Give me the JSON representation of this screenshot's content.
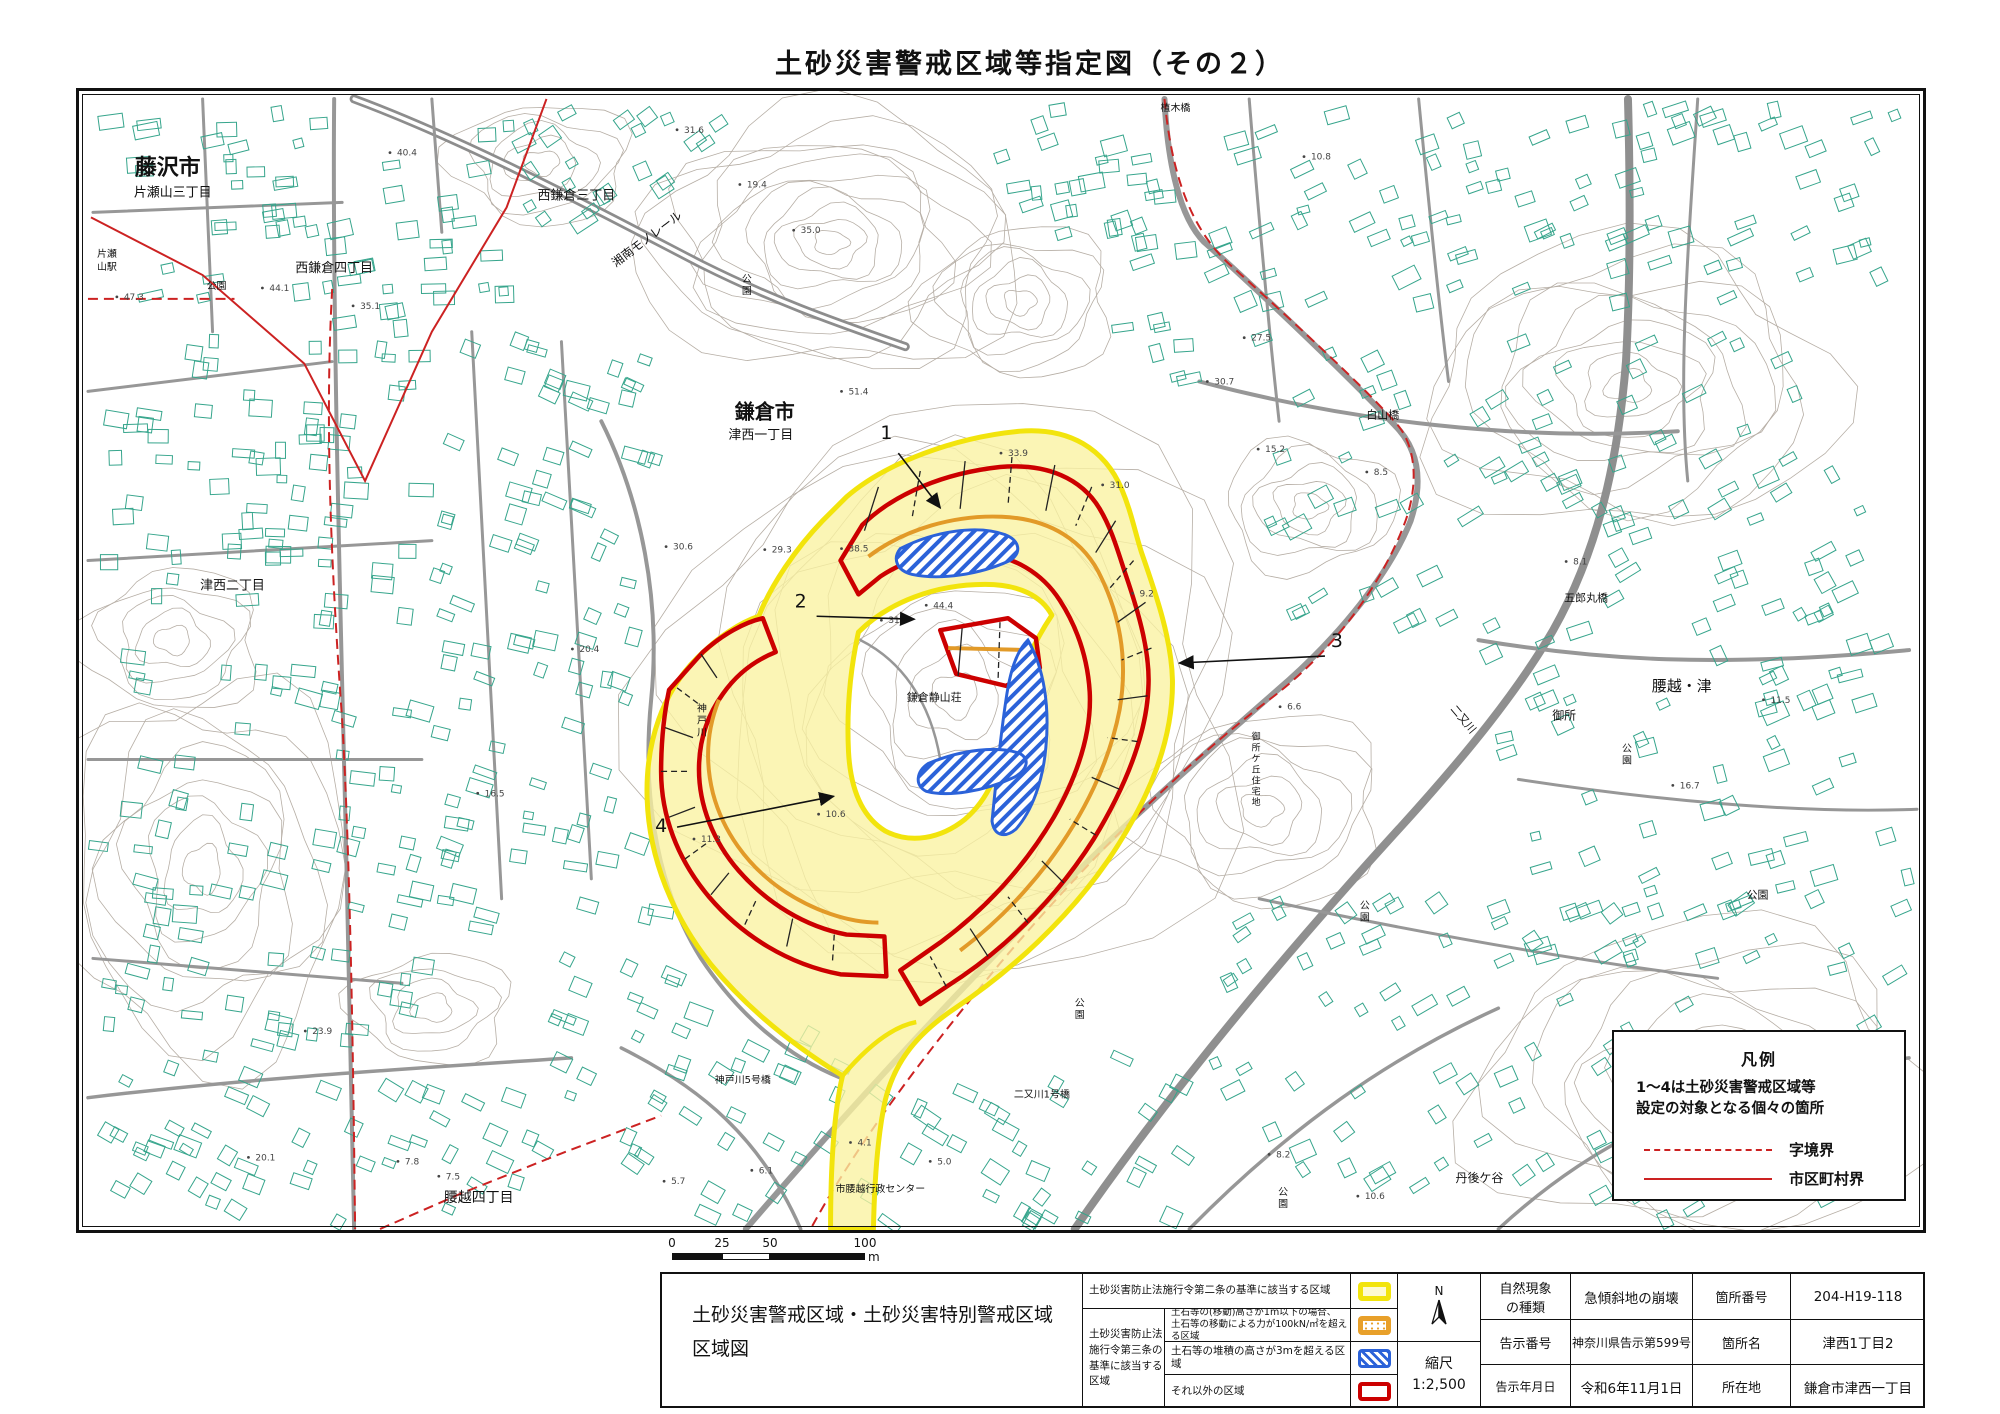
{
  "title": "土砂災害警戒区域等指定図（その２）",
  "legend_box": {
    "title": "凡例",
    "note": "1～4は土砂災害警戒区域等\n設定の対象となる個々の箇所",
    "dashed_label": "字境界",
    "solid_label": "市区町村界",
    "line_color": "#cc2222"
  },
  "scale_bar": {
    "ticks": [
      "0",
      "25",
      "50",
      "100"
    ],
    "unit": "m"
  },
  "bottom_table": {
    "map_title": "土砂災害警戒区域・土砂災害特別警戒区域\n区域図",
    "legend": {
      "row1": "土砂災害防止法施行令第二条の基準に該当する区域",
      "group_label": "土砂災害防止法\n施行令第三条の\n基準に該当する\n区域",
      "row2": "土石等の(移動)高さが1m以下の場合、\n土石等の移動による力が100kN/㎡を超える区域",
      "row3": "土石等の堆積の高さが3mを超える区域",
      "row4": "それ以外の区域",
      "swatch_colors": {
        "yellow": "#f2e40c",
        "orange": "#e8a02a",
        "blue": "#2b62d9",
        "red": "#cc0000"
      }
    },
    "compass_n": "N",
    "scale_label": "縮尺",
    "scale_value": "1:2,500",
    "fields": [
      {
        "label": "自然現象\nの種類",
        "value": "急傾斜地の崩壊",
        "label2": "箇所番号",
        "value2": "204-H19-118"
      },
      {
        "label": "告示番号",
        "value": "神奈川県告示第599号",
        "label2": "箇所名",
        "value2": "津西1丁目2"
      },
      {
        "label": "告示年月日",
        "value": "令和6年11月1日",
        "label2": "所在地",
        "value2": "鎌倉市津西一丁目"
      }
    ]
  },
  "map": {
    "labels": [
      {
        "t": "藤沢市",
        "x": 165,
        "y": 172,
        "s": 22,
        "b": 1
      },
      {
        "t": "片瀬山三丁目",
        "x": 170,
        "y": 194,
        "s": 13
      },
      {
        "t": "西鎌倉四丁目",
        "x": 332,
        "y": 270,
        "s": 13
      },
      {
        "t": "西鎌倉三丁目",
        "x": 575,
        "y": 197,
        "s": 13
      },
      {
        "t": "湘南モノレール",
        "x": 648,
        "y": 240,
        "s": 12,
        "r": -37
      },
      {
        "t": "片瀬",
        "x": 104,
        "y": 255,
        "s": 10
      },
      {
        "t": "山駅",
        "x": 104,
        "y": 268,
        "s": 10
      },
      {
        "t": "公園",
        "x": 214,
        "y": 287,
        "s": 10
      },
      {
        "t": "公園",
        "x": 746,
        "y": 280,
        "s": 10,
        "v": 1
      },
      {
        "t": "鎌倉市",
        "x": 764,
        "y": 417,
        "s": 20,
        "b": 1
      },
      {
        "t": "津西一丁目",
        "x": 760,
        "y": 438,
        "s": 13
      },
      {
        "t": "白山橋",
        "x": 1384,
        "y": 417,
        "s": 11
      },
      {
        "t": "植木橋",
        "x": 1176,
        "y": 108,
        "s": 10
      },
      {
        "t": "五郎丸橋",
        "x": 1588,
        "y": 601,
        "s": 11
      },
      {
        "t": "腰越・津",
        "x": 1684,
        "y": 691,
        "s": 15
      },
      {
        "t": "御所",
        "x": 1566,
        "y": 720,
        "s": 12
      },
      {
        "t": "公園",
        "x": 1629,
        "y": 752,
        "s": 10,
        "v": 1
      },
      {
        "t": "公園",
        "x": 1760,
        "y": 900,
        "s": 11
      },
      {
        "t": "公園",
        "x": 1366,
        "y": 910,
        "s": 10,
        "v": 1
      },
      {
        "t": "公園",
        "x": 1080,
        "y": 1008,
        "s": 10,
        "v": 1
      },
      {
        "t": "津西二丁目",
        "x": 230,
        "y": 589,
        "s": 13
      },
      {
        "t": "腰越四丁目",
        "x": 477,
        "y": 1205,
        "s": 14
      },
      {
        "t": "神戸川5号橋",
        "x": 742,
        "y": 1085,
        "s": 10
      },
      {
        "t": "市腰越行政センター",
        "x": 880,
        "y": 1195,
        "s": 10
      },
      {
        "t": "二又川1号橋",
        "x": 1042,
        "y": 1100,
        "s": 10
      },
      {
        "t": "丹後ケ谷",
        "x": 1481,
        "y": 1185,
        "s": 12
      },
      {
        "t": "公園",
        "x": 1284,
        "y": 1198,
        "s": 10,
        "v": 1
      },
      {
        "t": "二又川",
        "x": 1462,
        "y": 722,
        "s": 11,
        "r": 50
      },
      {
        "t": "神戸川",
        "x": 701,
        "y": 712,
        "s": 10,
        "v": 1
      },
      {
        "t": "鎌倉静山荘",
        "x": 934,
        "y": 701,
        "s": 11
      },
      {
        "t": "御所ケ丘住宅地",
        "x": 1257,
        "y": 740,
        "s": 9,
        "v": 1
      }
    ],
    "spot_heights": [
      {
        "v": "51.4",
        "x": 848,
        "y": 393
      },
      {
        "v": "33.9",
        "x": 1008,
        "y": 455
      },
      {
        "v": "44.4",
        "x": 933,
        "y": 608
      },
      {
        "v": "31.3",
        "x": 888,
        "y": 623
      },
      {
        "v": "38.5",
        "x": 848,
        "y": 551
      },
      {
        "v": "29.3",
        "x": 771,
        "y": 552
      },
      {
        "v": "30.6",
        "x": 672,
        "y": 549
      },
      {
        "v": "31.0",
        "x": 1110,
        "y": 487
      },
      {
        "v": "9.2",
        "x": 1140,
        "y": 596
      },
      {
        "v": "6.6",
        "x": 1288,
        "y": 710
      },
      {
        "v": "8.1",
        "x": 1575,
        "y": 564
      },
      {
        "v": "11.5",
        "x": 1773,
        "y": 703
      },
      {
        "v": "16.7",
        "x": 1682,
        "y": 789
      },
      {
        "v": "8.2",
        "x": 1277,
        "y": 1160
      },
      {
        "v": "10.6",
        "x": 1366,
        "y": 1202
      },
      {
        "v": "7.8",
        "x": 403,
        "y": 1167
      },
      {
        "v": "7.5",
        "x": 444,
        "y": 1182
      },
      {
        "v": "20.1",
        "x": 253,
        "y": 1163
      },
      {
        "v": "4.1",
        "x": 857,
        "y": 1148
      },
      {
        "v": "5.0",
        "x": 937,
        "y": 1167
      },
      {
        "v": "6.1",
        "x": 758,
        "y": 1176
      },
      {
        "v": "5.7",
        "x": 670,
        "y": 1187
      },
      {
        "v": "19.4",
        "x": 746,
        "y": 185
      },
      {
        "v": "35.0",
        "x": 800,
        "y": 231
      },
      {
        "v": "31.6",
        "x": 683,
        "y": 130
      },
      {
        "v": "30.7",
        "x": 1215,
        "y": 383
      },
      {
        "v": "27.5",
        "x": 1252,
        "y": 339
      },
      {
        "v": "15.2",
        "x": 1266,
        "y": 451
      },
      {
        "v": "10.8",
        "x": 1312,
        "y": 157
      },
      {
        "v": "8.5",
        "x": 1375,
        "y": 474
      },
      {
        "v": "40.4",
        "x": 395,
        "y": 153
      },
      {
        "v": "44.1",
        "x": 267,
        "y": 289
      },
      {
        "v": "35.1",
        "x": 358,
        "y": 307
      },
      {
        "v": "47.3",
        "x": 121,
        "y": 298
      },
      {
        "v": "16.5",
        "x": 483,
        "y": 797
      },
      {
        "v": "10.6",
        "x": 825,
        "y": 818
      },
      {
        "v": "11.3",
        "x": 700,
        "y": 843
      },
      {
        "v": "23.9",
        "x": 310,
        "y": 1036
      },
      {
        "v": "20.4",
        "x": 578,
        "y": 652
      }
    ],
    "callouts": [
      {
        "n": "1",
        "tx": 886,
        "ty": 438,
        "x1": 898,
        "y1": 452,
        "x2": 940,
        "y2": 507
      },
      {
        "n": "2",
        "tx": 800,
        "ty": 607,
        "x1": 816,
        "y1": 616,
        "x2": 914,
        "y2": 619
      },
      {
        "n": "3",
        "tx": 1338,
        "ty": 647,
        "x1": 1326,
        "y1": 656,
        "x2": 1180,
        "y2": 663
      },
      {
        "n": "4",
        "tx": 660,
        "ty": 833,
        "x1": 676,
        "y1": 828,
        "x2": 833,
        "y2": 797
      }
    ],
    "zone_colors": {
      "warning_yellow": "#f2e40c",
      "special_red": "#cc0000",
      "force_orange": "#e29a28",
      "deposit_blue": "#2b62d9",
      "boundary_red": "#cc2222",
      "building_teal": "#36a58c",
      "contour_gray": "#b6aea5"
    }
  }
}
